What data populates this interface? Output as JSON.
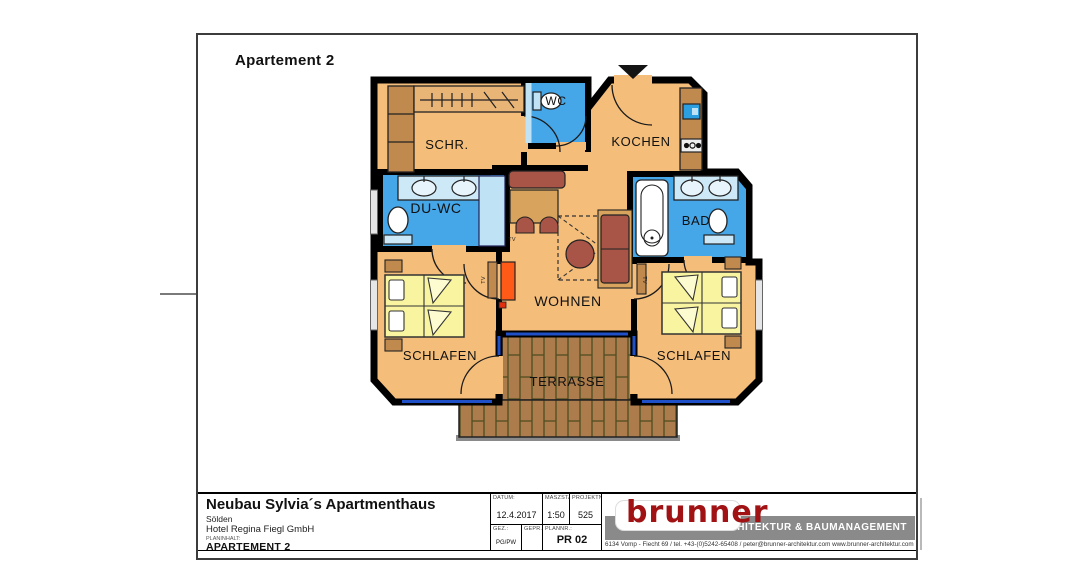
{
  "sheet": {
    "header_title": "Apartement 2"
  },
  "plan": {
    "rooms": {
      "wc": "WC",
      "schrank": "SCHR.",
      "kochen": "KOCHEN",
      "duwc": "DU-WC",
      "bad": "BAD",
      "wohnen": "WOHNEN",
      "schlafen_links": "SCHLAFEN",
      "schlafen_rechts": "SCHLAFEN",
      "terrasse": "TERRASSE"
    },
    "annotations": {
      "tv": "TV"
    },
    "colors": {
      "floor": "#F4BD7A",
      "wet_room": "#45A6E8",
      "fixture_light_blue": "#CDE9F8",
      "wood_furniture": "#C08A4F",
      "bed_yellow": "#F8F4A0",
      "seating_red": "#A85548",
      "fireplace_orange": "#FF5A17",
      "terrace_plank": "#AD7C4C",
      "window_frame_blue": "#2050C8",
      "wall_black": "#000000"
    }
  },
  "title_block": {
    "project": "Neubau Sylvia´s Apartmenthaus",
    "location": "Sölden",
    "client": "Hotel Regina Fiegl GmbH",
    "plan_content_label": "PLANINHALT:",
    "plan_content": "APARTEMENT 2",
    "fields": {
      "datum_label": "DATUM:",
      "datum": "12.4.2017",
      "massstab_label": "MASZSTAB:",
      "massstab": "1:50",
      "projektnr_label": "PROJEKTNR.:",
      "projektnr": "525",
      "gez_label": "GEZ.:",
      "gez": "PG/PW",
      "gepr_label": "GEPR.:",
      "gepr": "",
      "plannr_label": "PLANNR.:",
      "plannr": "PR 02"
    },
    "firm": {
      "name": "brunner",
      "tagline": "ARCHITEKTUR & BAUMANAGEMENT",
      "address": "6134 Vomp - Fiecht 69 / tel. +43-(0)5242-65408 / peter@brunner-architektur.com   www.brunner-architektur.com",
      "brand_red": "#a01214",
      "banner_gray": "#8a8a8a"
    }
  }
}
